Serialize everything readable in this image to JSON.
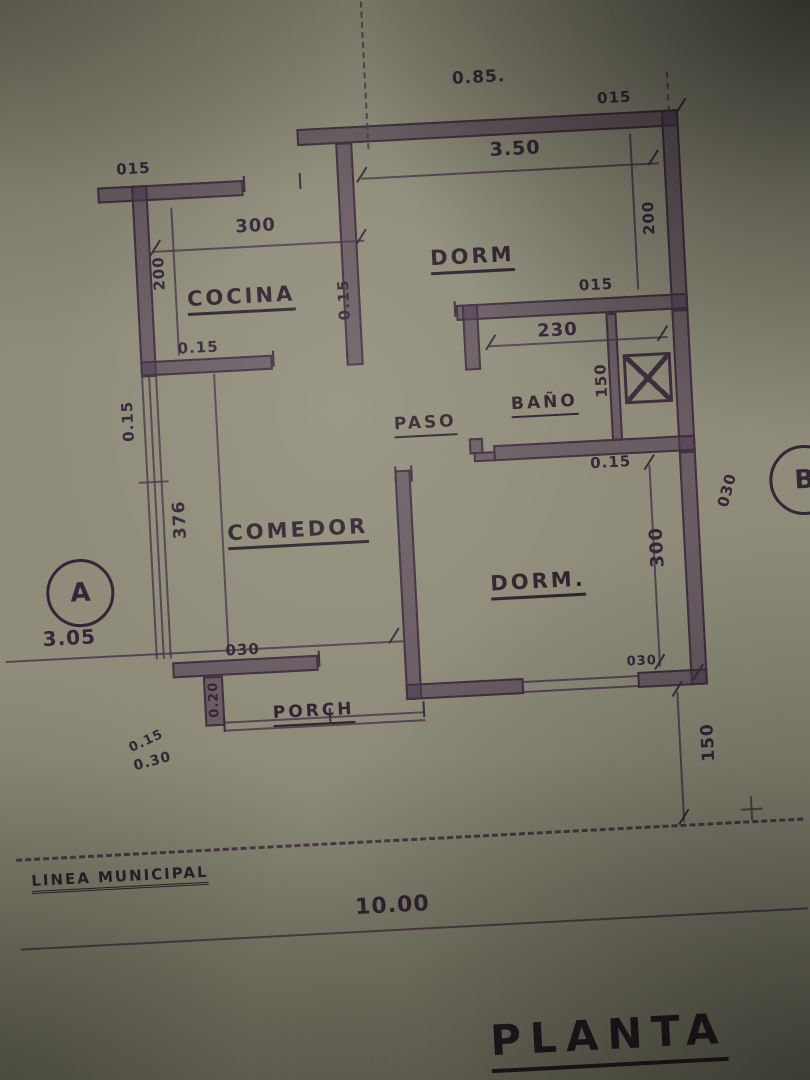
{
  "photo": {
    "paper_color": "#8f8d7a",
    "ink_color": "#41303f",
    "wall_fill": "#4e3a52"
  },
  "title": "PLANTA",
  "markers": {
    "a": "A",
    "b": "B"
  },
  "rooms": {
    "cocina": "COCINA",
    "dorm_top": "DORM",
    "paso": "PASO",
    "bano": "BAÑO",
    "comedor": "COMEDOR",
    "dorm_bottom": "DORM.",
    "porch": "PORCH"
  },
  "dims": {
    "top_note": "0.85.",
    "top_left_wall": "015",
    "cocina_width": "300",
    "cocina_depth": "200",
    "cocina_wall": "0.15",
    "left_wall": "0.15",
    "divider_wall": "0.15",
    "dorm_top_width": "3.50",
    "top_right_wall": "015",
    "dorm_top_depth": "200",
    "dorm_wall": "015",
    "bano_width": "230",
    "bano_depth": "150",
    "bano_wall": "0.15",
    "comedor_depth": "376",
    "comedor_wall": "030",
    "porch_wall": "0.20",
    "porch_corner_a": "0.15",
    "porch_corner_b": "0.30",
    "dorm_bottom_depth": "300",
    "right_wall": "030",
    "dorm_bottom_wall": "030",
    "front_setback": "150",
    "left_offset": "3.05",
    "frontage": "10.00"
  },
  "site": {
    "municipal_line": "LINEA MUNICIPAL"
  }
}
